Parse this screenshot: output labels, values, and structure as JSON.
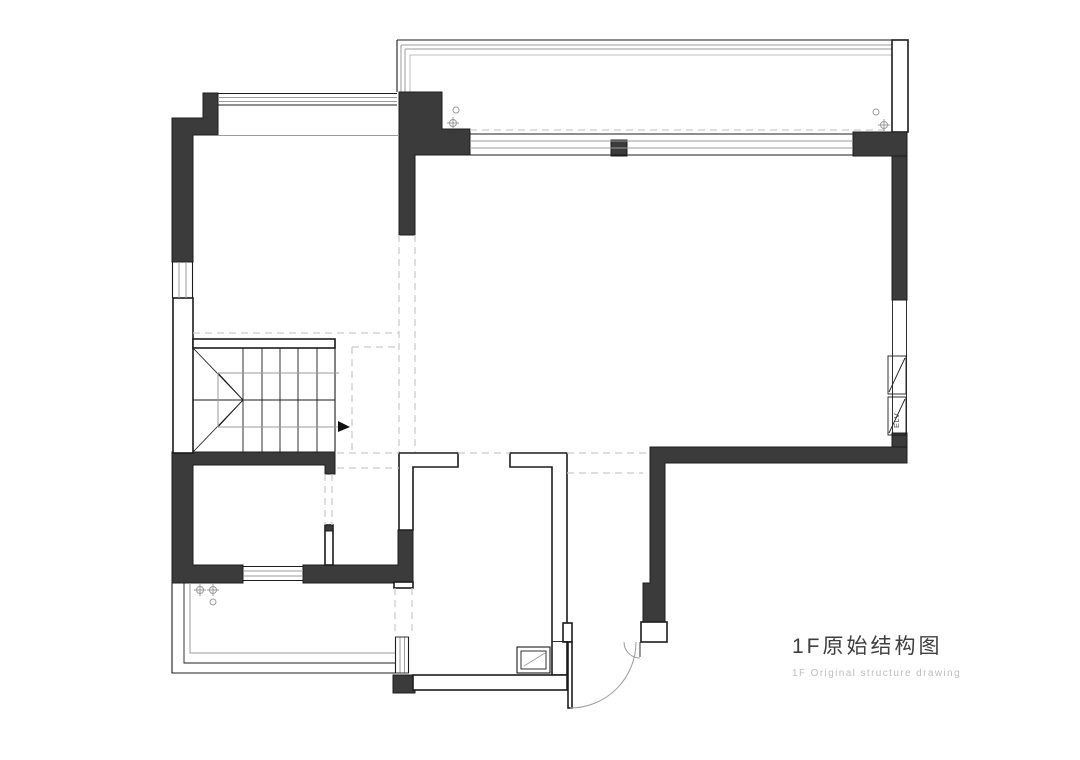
{
  "drawing": {
    "title": "1F原始结构图",
    "subtitle": "1F Original structure drawing",
    "shaft_label": "ELV",
    "colors": {
      "background": "#ffffff",
      "wall_fill": "#3b3b3b",
      "line": "#1c1c1c",
      "gray_line": "#9b9b9b",
      "faint_line": "#bdbdbd",
      "dashed_line": "#c9c9c9",
      "title_color": "#3f3f3f",
      "subtitle_color": "#bdbdbd"
    }
  }
}
